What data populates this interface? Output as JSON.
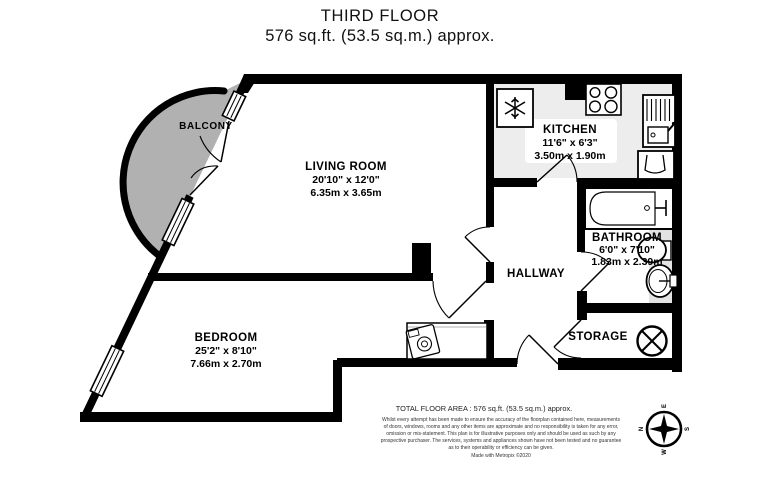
{
  "title": {
    "line1": "THIRD FLOOR",
    "line2": "576 sq.ft. (53.5 sq.m.) approx."
  },
  "rooms": {
    "balcony": {
      "name": "BALCONY"
    },
    "living_room": {
      "name": "LIVING ROOM",
      "imperial": "20'10\" x 12'0\"",
      "metric": "6.35m x 3.65m"
    },
    "kitchen": {
      "name": "KITCHEN",
      "imperial": "11'6\" x 6'3\"",
      "metric": "3.50m x 1.90m"
    },
    "bathroom": {
      "name": "BATHROOM",
      "imperial": "6'0\" x 7'10\"",
      "metric": "1.83m x 2.39m"
    },
    "hallway": {
      "name": "HALLWAY"
    },
    "storage": {
      "name": "STORAGE"
    },
    "bedroom": {
      "name": "BEDROOM",
      "imperial": "25'2\" x 8'10\"",
      "metric": "7.66m x 2.70m"
    }
  },
  "footer": {
    "total_area": "TOTAL FLOOR AREA : 576 sq.ft. (53.5 sq.m.) approx.",
    "disclaimer_lines": [
      "Whilst every attempt has been made to ensure the accuracy of the floorplan contained here, measurements",
      "of doors, windows, rooms and any other items are approximate and no responsibility is taken for any error,",
      "omission or mis-statement. This plan is for illustrative purposes only and should be used as such by any",
      "prospective purchaser. The services, systems and appliances shown have not been tested and no guarantee",
      "as to their operability or efficiency can be given."
    ],
    "credit": "Made with Metropix ©2020"
  },
  "compass": {
    "north": "N",
    "east": "E",
    "south": "S",
    "west": "W"
  },
  "colors": {
    "wall": "#000000",
    "balcony_fill": "#b1b1b1",
    "kitchen_floor": "#ededed",
    "bathroom_strip": "#e3e3e3"
  }
}
